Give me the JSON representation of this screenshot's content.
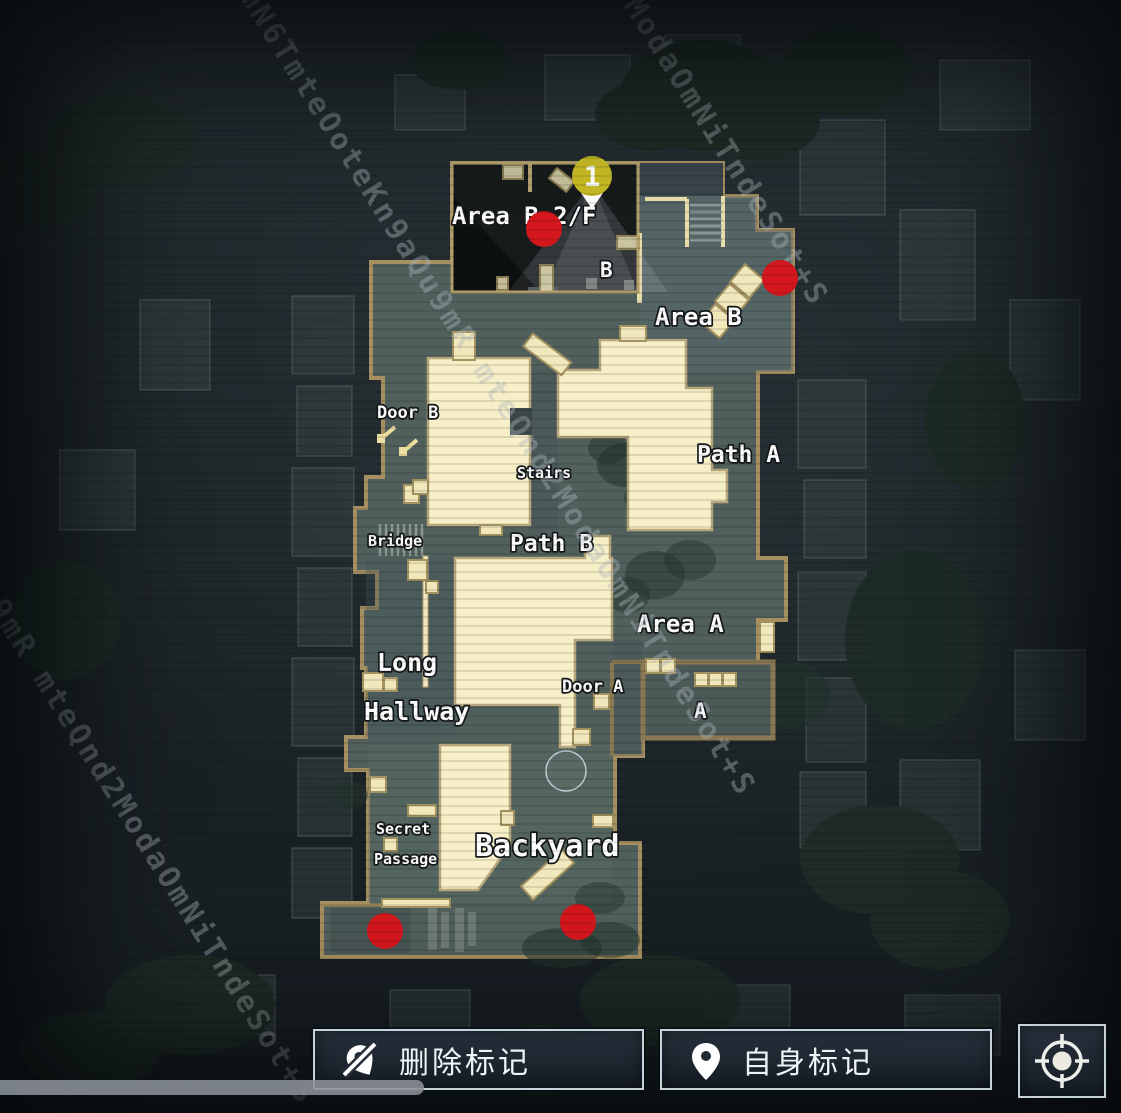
{
  "map": {
    "labels": [
      {
        "text": "Area B 2/F"
      },
      {
        "text": "B"
      },
      {
        "text": "Area B"
      },
      {
        "text": "Door B"
      },
      {
        "text": "Stairs"
      },
      {
        "text": "Path A"
      },
      {
        "text": "Bridge"
      },
      {
        "text": "Path B"
      },
      {
        "text": "Area A"
      },
      {
        "text": "Long"
      },
      {
        "text": "Hallway"
      },
      {
        "text": "Door A"
      },
      {
        "text": "A"
      },
      {
        "text": "Secret"
      },
      {
        "text": "Passage"
      },
      {
        "text": "Backyard"
      }
    ],
    "ping": {
      "number": "1",
      "x": 592,
      "y": 176
    },
    "red_markers": [
      {
        "x": 544,
        "y": 229
      },
      {
        "x": 780,
        "y": 278
      },
      {
        "x": 385,
        "y": 931
      },
      {
        "x": 578,
        "y": 922
      }
    ],
    "empty_circle": {
      "x": 566,
      "y": 771
    }
  },
  "watermark": {
    "diag1": "mN6TmteOoteKn9aQu9mR mteQnd2ModaOmNiTndeSot+S",
    "diag2": "mteQnd2ModaOmNiTndeSot+S",
    "diag3": "9mR mteQnd2ModaOmNiTndeSot+S"
  },
  "toolbar": {
    "delete_mark": "删除标记",
    "self_mark": "自身标记"
  },
  "colors": {
    "room_fill": "#f6efc8",
    "wall": "#a68f60",
    "floor": "#51605c",
    "red_marker": "#d4171d",
    "ping_yellow": "#c6ba25"
  }
}
